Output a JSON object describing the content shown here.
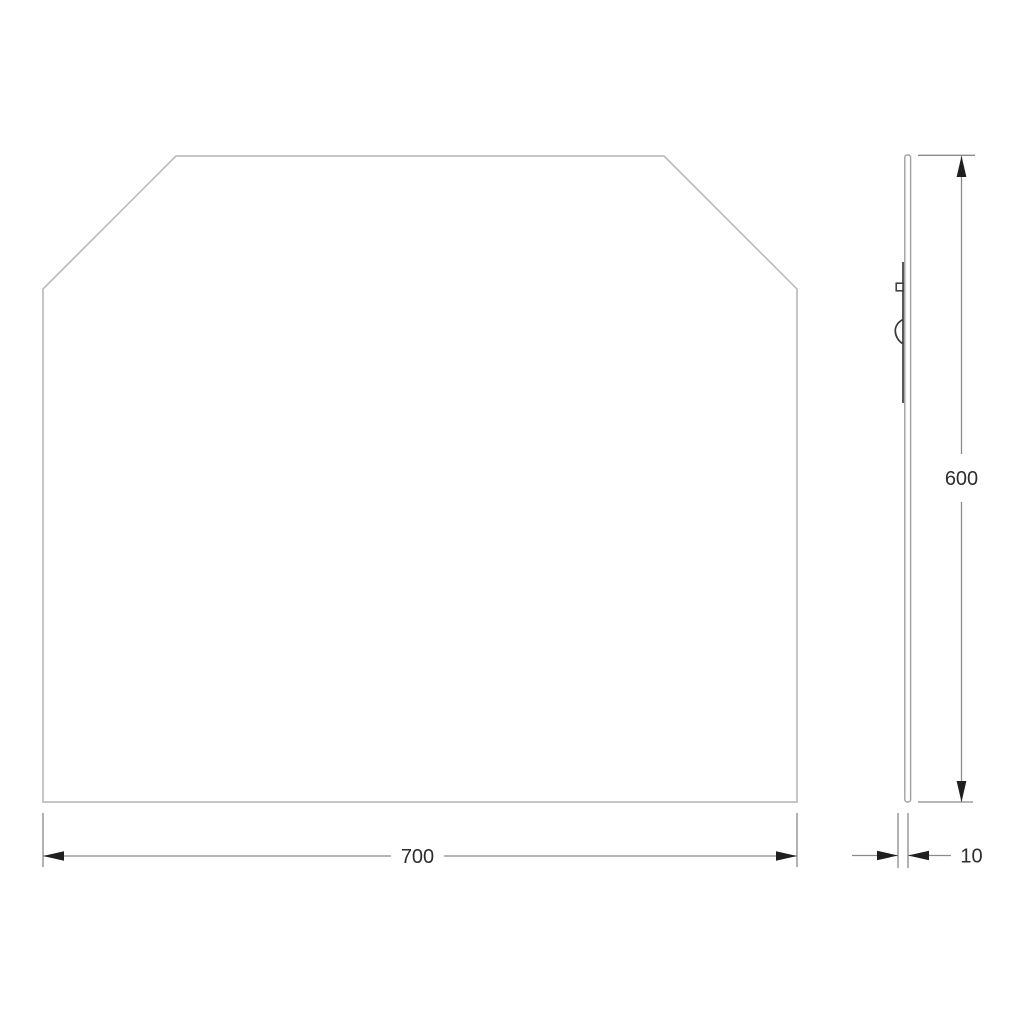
{
  "dimensions": {
    "width": "700",
    "height": "600",
    "thickness": "10"
  },
  "colors": {
    "outline": "#b4b4b4",
    "panel": "#a0a0a0",
    "bracket": "#3a3a3a",
    "dim": "#8a8a8a",
    "arrow": "#1f1f1f",
    "label": "#2d2d2d"
  }
}
